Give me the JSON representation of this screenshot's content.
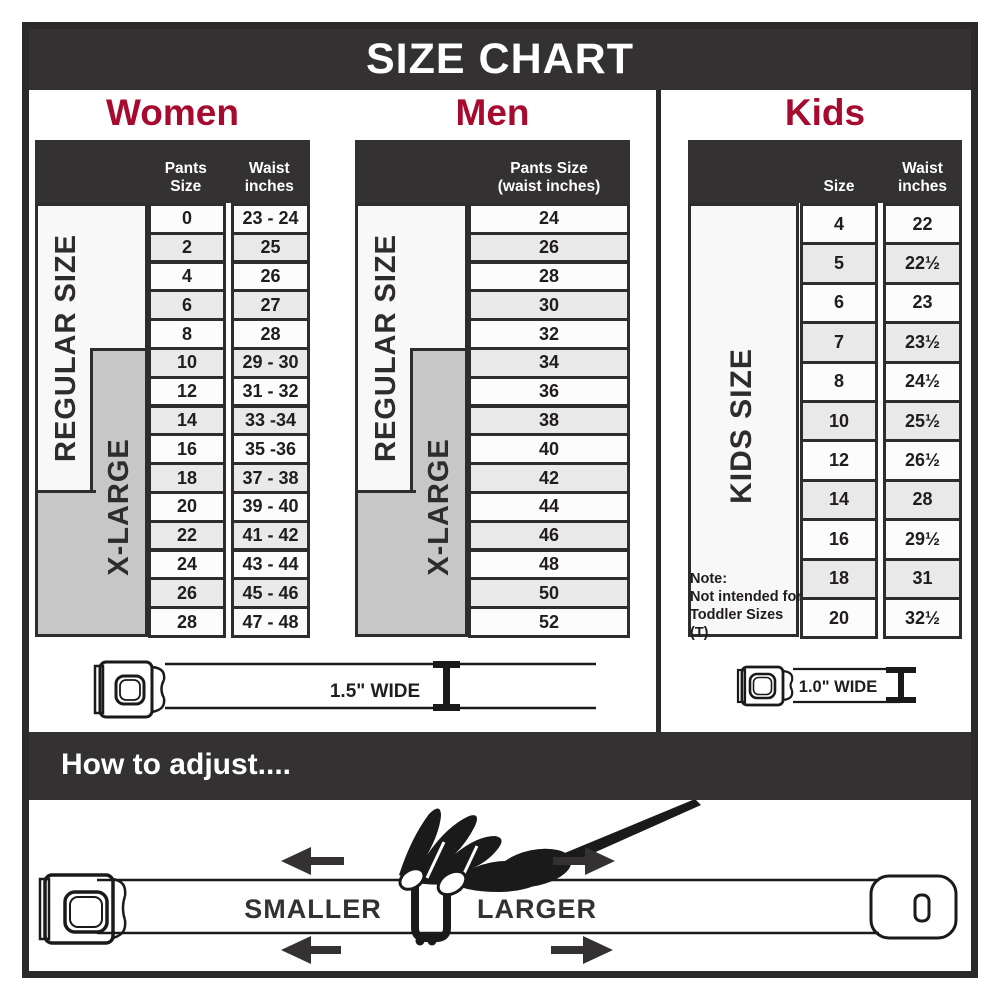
{
  "title_bar": {
    "title": "SIZE CHART"
  },
  "women": {
    "title": "Women",
    "col1_header": "Pants Size",
    "col2_header": "Waist\ninches",
    "regular_label": "REGULAR SIZE",
    "xlarge_label": "X-LARGE",
    "rows": [
      [
        "0",
        "23 - 24"
      ],
      [
        "2",
        "25"
      ],
      [
        "4",
        "26"
      ],
      [
        "6",
        "27"
      ],
      [
        "8",
        "28"
      ],
      [
        "10",
        "29 - 30"
      ],
      [
        "12",
        "31 - 32"
      ],
      [
        "14",
        "33 -34"
      ],
      [
        "16",
        "35 -36"
      ],
      [
        "18",
        "37 - 38"
      ],
      [
        "20",
        "39 - 40"
      ],
      [
        "22",
        "41 - 42"
      ],
      [
        "24",
        "43 - 44"
      ],
      [
        "26",
        "45 - 46"
      ],
      [
        "28",
        "47 - 48"
      ]
    ]
  },
  "men": {
    "title": "Men",
    "col_header": "Pants Size\n(waist inches)",
    "regular_label": "REGULAR SIZE",
    "xlarge_label": "X-LARGE",
    "rows": [
      "24",
      "26",
      "28",
      "30",
      "32",
      "34",
      "36",
      "38",
      "40",
      "42",
      "44",
      "46",
      "48",
      "50",
      "52"
    ]
  },
  "kids": {
    "title": "Kids",
    "col1_header": "Size",
    "col2_header": "Waist\ninches",
    "size_label": "KIDS SIZE",
    "note": "Note:\nNot intended for\nToddler Sizes (T)",
    "rows": [
      [
        "4",
        "22"
      ],
      [
        "5",
        "22½"
      ],
      [
        "6",
        "23"
      ],
      [
        "7",
        "23½"
      ],
      [
        "8",
        "24½"
      ],
      [
        "10",
        "25½"
      ],
      [
        "12",
        "26½"
      ],
      [
        "14",
        "28"
      ],
      [
        "16",
        "29½"
      ],
      [
        "18",
        "31"
      ],
      [
        "20",
        "32½"
      ]
    ]
  },
  "wm_belt": {
    "width_label": "1.5\" WIDE"
  },
  "kids_belt": {
    "width_label": "1.0\" WIDE"
  },
  "adjust": {
    "title": "How to adjust....",
    "smaller_label": "SMALLER",
    "larger_label": "LARGER"
  },
  "colors": {
    "charcoal": "#333132",
    "crimson": "#a60b2f",
    "row_gray": "#e9e9e9",
    "row_white": "#fcfcfc",
    "label_gray": "#c7c7c7"
  }
}
